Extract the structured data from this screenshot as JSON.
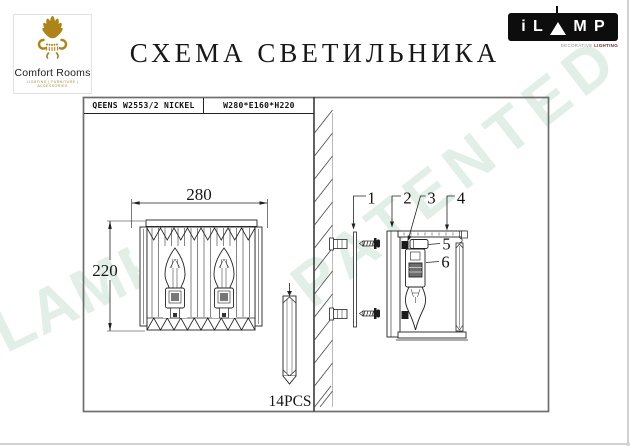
{
  "header": {
    "title": "СХЕМА СВЕТИЛЬНИКА",
    "brand": {
      "name": "Comfort Rooms",
      "tagline": "LIGHTING | FURNITURE | ACCESSORIES",
      "crown_color": "#ae8418"
    },
    "ilamp": {
      "letters": [
        "i",
        "L",
        "M",
        "P"
      ],
      "tagline_main": "DECORATIVE ",
      "tagline_accent": "LIGHTING",
      "background": "#0d0d0d"
    }
  },
  "spec_table": {
    "model": "QEENS W2553/2 NICKEL",
    "size": "W280*E160*H220"
  },
  "front_view": {
    "width_label": "280",
    "height_label": "220"
  },
  "crystal_detail": {
    "count_label": "14PCS"
  },
  "callouts": [
    "1",
    "2",
    "3",
    "4",
    "5",
    "6"
  ],
  "watermarks": {
    "patented": "PATENTED",
    "brand": "iLAMP",
    "color": "#e1efe7"
  },
  "colors": {
    "line": "#222222",
    "border": "#6e6e6e"
  }
}
